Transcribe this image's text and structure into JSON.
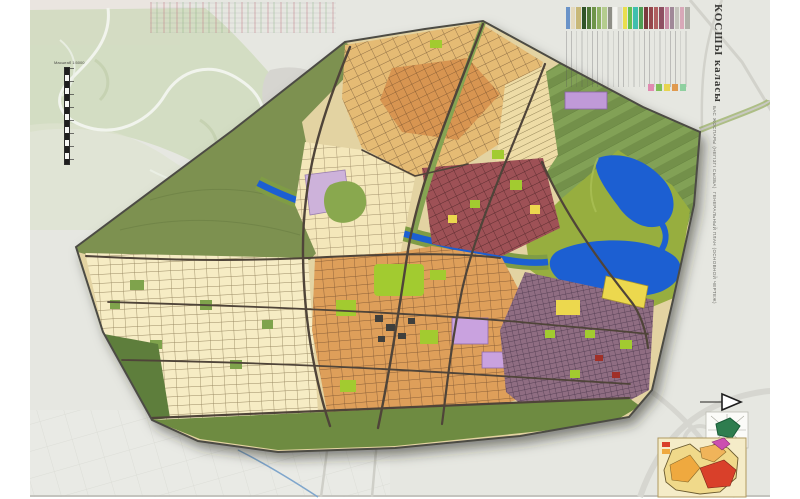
{
  "sheet": {
    "title_block": {
      "city_name": "КОСШЫ каласы",
      "subtitle_kk": "БАС ЖОСПАРЫ (НЕГІЗГІ СЫЗБА)",
      "subtitle_ru": "ГЕНЕРАЛЬНЫЙ ПЛАН (ОСНОВНОЙ ЧЕРТЕЖ)"
    },
    "scale_bar": {
      "label": "Масштаб 1:5000"
    }
  },
  "legend": {
    "primary_swatches": [
      "#6a93c8",
      "#e4d9bc",
      "#c8b878",
      "#2f5328",
      "#4f7838",
      "#6e9448",
      "#8fb264",
      "#b4cc8e",
      "#8e8e86",
      "#f4f4f0",
      "#d9d9d2",
      "#eade4e",
      "#63c053",
      "#3fbfae",
      "#4f9e54",
      "#7c3a3e",
      "#96474c",
      "#b06060",
      "#8f4f62",
      "#c98fa6",
      "#a08898",
      "#c4c4bc",
      "#d8a8b8",
      "#b0b0a8"
    ],
    "secondary_swatches": [
      "#e08ab0",
      "#7fbf57",
      "#e8d44f",
      "#e09a4f",
      "#8fd0a0"
    ]
  },
  "map": {
    "colors": {
      "sheet_background": "#e6e7e1",
      "floodplain_green": "#cfd9bb",
      "city_green_buffer": "#7d9150",
      "agriculture_stripes": "#73904a",
      "marsh_green": "#97ae3f",
      "water_blue": "#1c5fd2",
      "cream_blocks": "#f4e7ba",
      "tan_blocks": "#e5bb74",
      "orange_blocks": "#de9f5a",
      "orange_core_blocks": "#d89551",
      "maroon_blocks": "#9e5156",
      "dense_mauve_blocks": "#8f6d82",
      "lime_park": "#a2cb30",
      "yellow_blocks": "#ecd84e",
      "purple_block": "#c09ad8",
      "road_dark": "#4f4439",
      "south_greenbelt": "#6e8b41"
    },
    "inset_stages_colors": {
      "base": "#f0d98a",
      "stage_orange": "#efa93f",
      "stage_red": "#d9402a",
      "stage_magenta": "#cc4fb0"
    }
  },
  "icons": {
    "north_arrow_icon": "▶"
  }
}
